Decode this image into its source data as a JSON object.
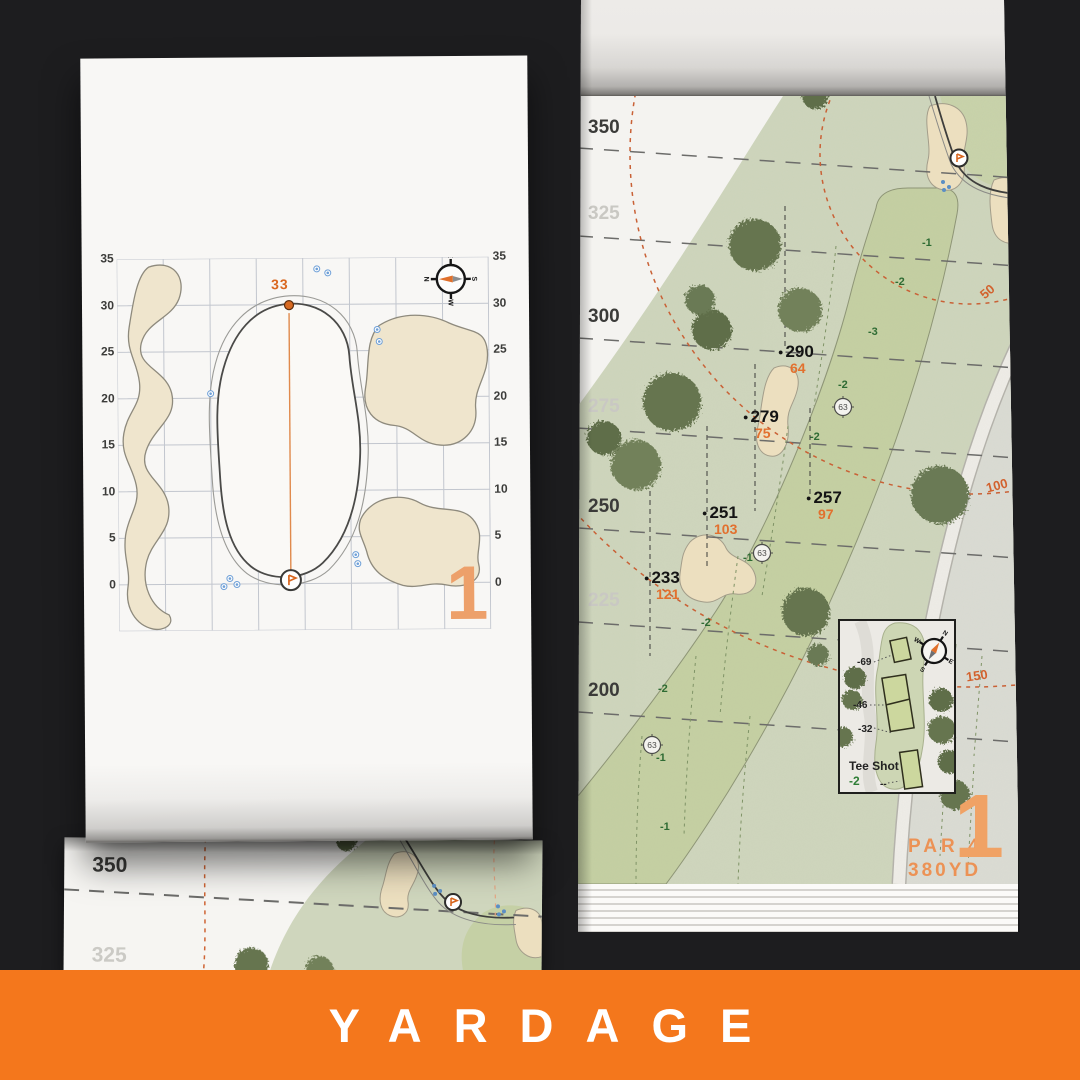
{
  "banner": {
    "title": "YARDAGE",
    "bg_color": "#F4771C"
  },
  "colors": {
    "accent_orange": "#E2702E",
    "big_number_orange": "#F0A265",
    "sand": "#EDE1C1",
    "fairway_green": "#C5D0A3",
    "rough_green": "#CFD6BD",
    "putting_green": "#C9D3AB",
    "tree_green": "#6B7A54",
    "background": "#1D1D1F",
    "elevation_green": "#2E6B33",
    "marker_black": "#141414"
  },
  "left_page": {
    "hole_number": "1",
    "pin_distance": "33",
    "axis_labels": [
      "35",
      "30",
      "25",
      "20",
      "15",
      "10",
      "5",
      "0"
    ],
    "compass": {
      "n": "N",
      "e": "E",
      "s": "S",
      "w": "W"
    }
  },
  "right_page": {
    "hole_number": "1",
    "par_label": "PAR 4",
    "yardage_label": "380YD",
    "distance_labels": [
      {
        "text": "350",
        "tone": "dark",
        "y": 117
      },
      {
        "text": "325",
        "tone": "light",
        "y": 203
      },
      {
        "text": "300",
        "tone": "dark",
        "y": 306
      },
      {
        "text": "275",
        "tone": "light",
        "y": 396
      },
      {
        "text": "250",
        "tone": "dark",
        "y": 496
      },
      {
        "text": "225",
        "tone": "light",
        "y": 590
      },
      {
        "text": "200",
        "tone": "dark",
        "y": 680
      }
    ],
    "arc_labels": [
      {
        "text": "50",
        "x": 402,
        "y": 284,
        "rot": -40
      },
      {
        "text": "100",
        "x": 408,
        "y": 478,
        "rot": -15
      },
      {
        "text": "150",
        "x": 388,
        "y": 668,
        "rot": -8
      }
    ],
    "markers": [
      {
        "carry": "290",
        "to_green": "64",
        "x": 200,
        "y": 342
      },
      {
        "carry": "279",
        "to_green": "75",
        "x": 165,
        "y": 407
      },
      {
        "carry": "257",
        "to_green": "97",
        "x": 228,
        "y": 488
      },
      {
        "carry": "251",
        "to_green": "103",
        "x": 124,
        "y": 503
      },
      {
        "carry": "233",
        "to_green": "121",
        "x": 66,
        "y": 568
      }
    ],
    "elevations": [
      {
        "value": "-1",
        "x": 344,
        "y": 237
      },
      {
        "value": "-2",
        "x": 317,
        "y": 276
      },
      {
        "value": "-3",
        "x": 290,
        "y": 326
      },
      {
        "value": "-2",
        "x": 260,
        "y": 379
      },
      {
        "value": "-2",
        "x": 232,
        "y": 431
      },
      {
        "value": "-1",
        "x": 165,
        "y": 552
      },
      {
        "value": "-2",
        "x": 123,
        "y": 617
      },
      {
        "value": "-2",
        "x": 80,
        "y": 683
      },
      {
        "value": "-1",
        "x": 78,
        "y": 752
      },
      {
        "value": "-1",
        "x": 82,
        "y": 821
      }
    ],
    "sprinkler_head": "63",
    "tee_box": {
      "title": "Tee Shot",
      "elevation": "-2",
      "distances": [
        {
          "text": "-69",
          "x": 17,
          "y": 36
        },
        {
          "text": "-46",
          "x": 13,
          "y": 79
        },
        {
          "text": "-32",
          "x": 18,
          "y": 103
        },
        {
          "text": "--",
          "x": 40,
          "y": 158
        }
      ]
    },
    "compass": {
      "n": "N",
      "e": "E",
      "s": "S",
      "w": "W"
    }
  },
  "under_page": {
    "labels": [
      "350",
      "325"
    ]
  }
}
